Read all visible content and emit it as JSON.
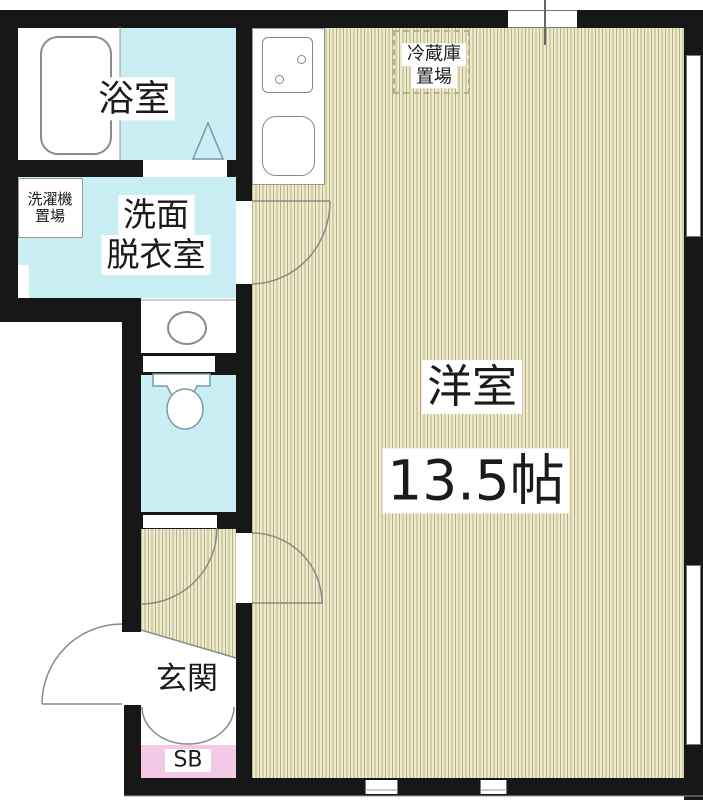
{
  "title": "apartment floor plan",
  "rooms": {
    "bathroom": {
      "name": "浴室"
    },
    "laundry": {
      "line1": "洗濯機",
      "line2": "置場"
    },
    "washroom": {
      "line1": "洗面",
      "line2": "脱衣室"
    },
    "fridge": {
      "line1": "冷蔵庫",
      "line2": "置場"
    },
    "western_room": {
      "name": "洋室",
      "area": "13.5帖"
    },
    "entrance": {
      "name": "玄関"
    },
    "shoe_box": {
      "name": "SB"
    }
  },
  "colors": {
    "wall": "#171717",
    "water": "#c9eff4",
    "stripeLight": "#edeacd",
    "stripeDark": "#b5b183",
    "pink": "#f4c9e6",
    "line": "#8a8a8a",
    "fixture": "#7f98a6",
    "ink": "#1b1b1b"
  }
}
